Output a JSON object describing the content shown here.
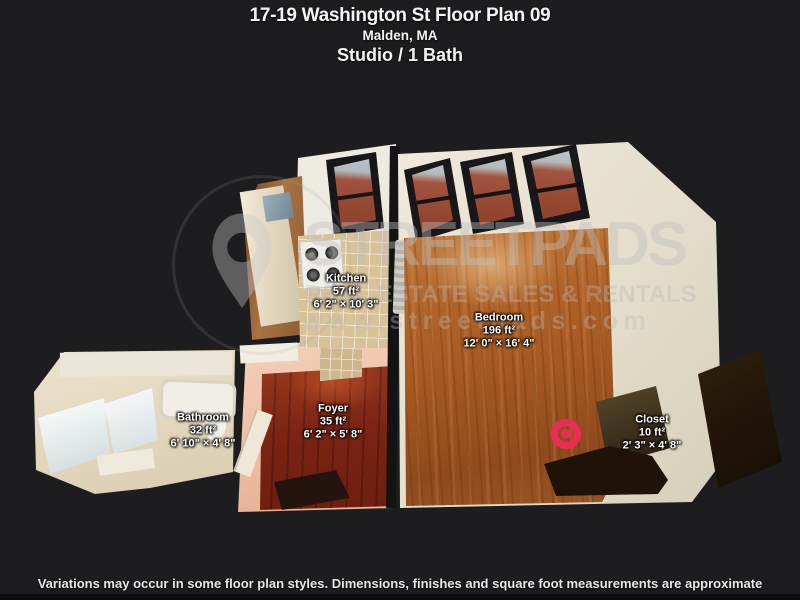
{
  "header": {
    "title": "17-19 Washington St Floor Plan 09",
    "location": "Malden, MA",
    "unit_type": "Studio / 1 Bath"
  },
  "rooms": [
    {
      "name": "Kitchen",
      "area": "57 ft²",
      "dimensions": "6' 2\" × 10' 3\""
    },
    {
      "name": "Bedroom",
      "area": "196 ft²",
      "dimensions": "12' 0\" × 16' 4\""
    },
    {
      "name": "Foyer",
      "area": "35 ft²",
      "dimensions": "6' 2\" × 5' 8\""
    },
    {
      "name": "Bathroom",
      "area": "32 ft²",
      "dimensions": "6' 10\" × 4' 8\""
    },
    {
      "name": "Closet",
      "area": "10 ft²",
      "dimensions": "2' 3\" × 4' 8\""
    }
  ],
  "watermark": {
    "brand": "STREETPADS",
    "tagline": "REAL ESTATE SALES & RENTALS",
    "website": "www.streetpads.com",
    "logo": "location-pin-icon"
  },
  "footer": {
    "disclaimer": "Variations may occur in some floor plan styles. Dimensions, finishes and square foot measurements are approximate"
  },
  "marker": {
    "type": "bullseye-marker-icon",
    "color": "#ea2d57"
  },
  "colors": {
    "background": "#1d1d1f",
    "marker_red": "#ea2d57",
    "bedroom_floor": "#a85c24",
    "foyer_floor": "#7c2414",
    "kitchen_tile": "#d8c298",
    "walls_white": "#e9e4d6",
    "foyer_walls": "#efc3ab",
    "bathroom_cream": "#e2d6bc"
  }
}
